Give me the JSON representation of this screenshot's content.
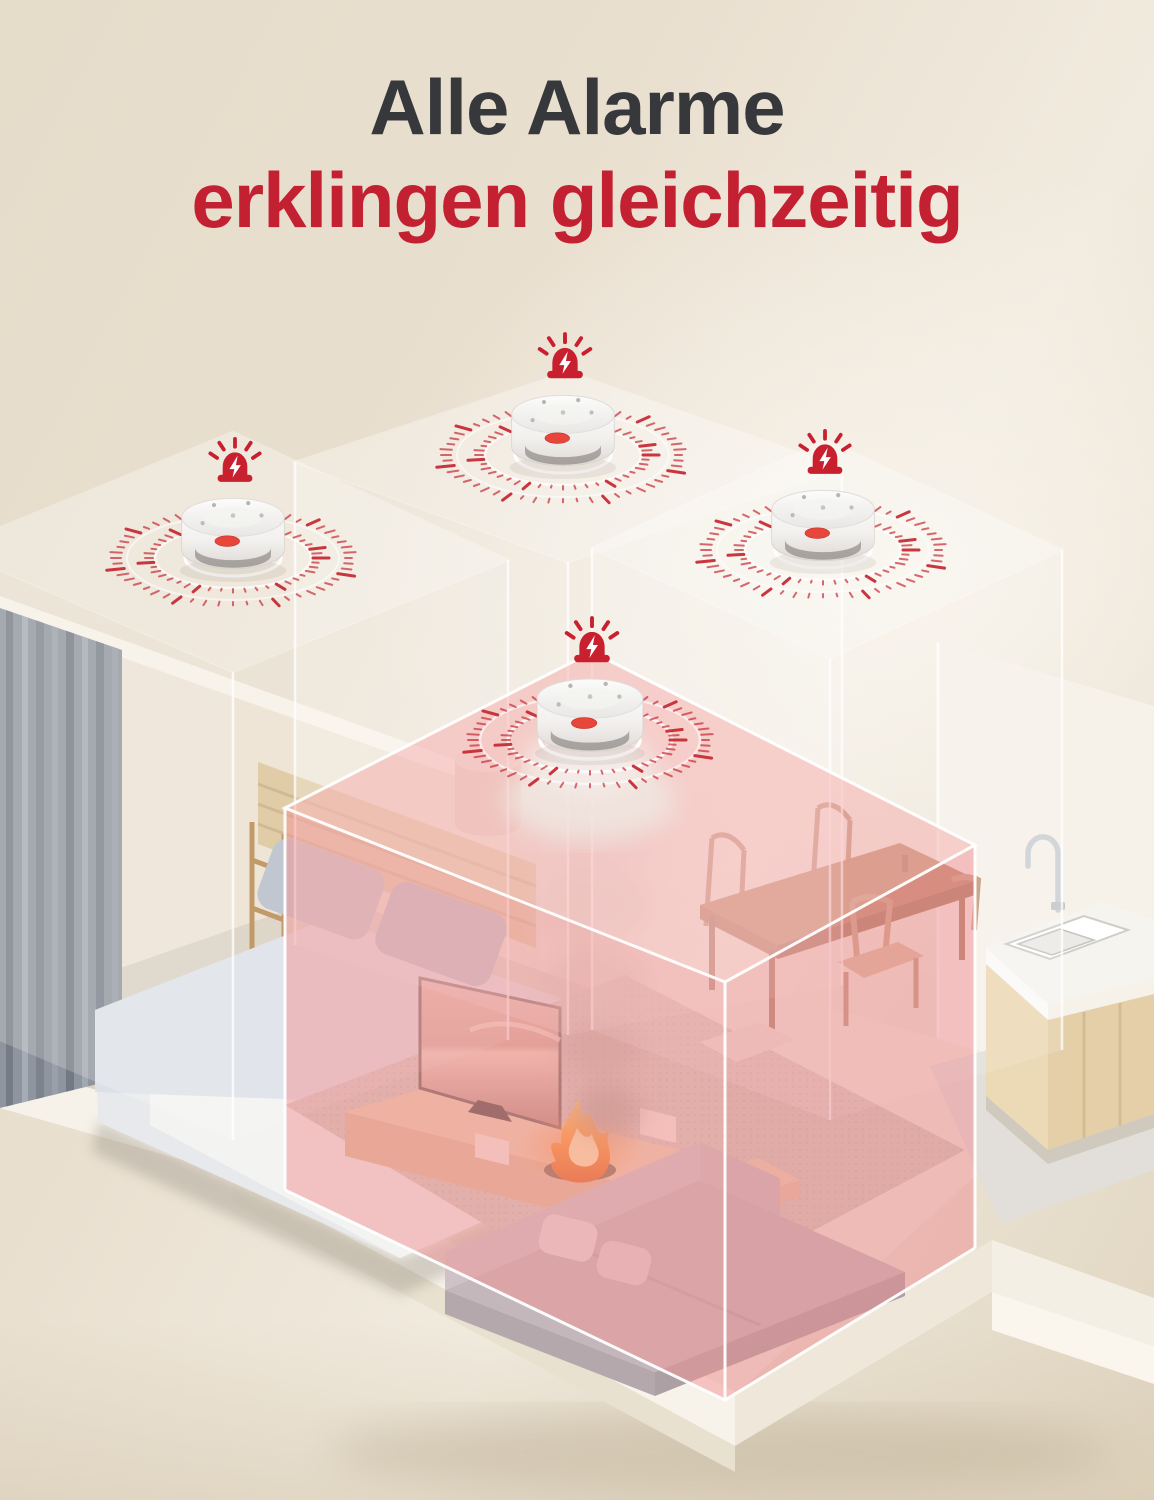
{
  "title": {
    "line1": "Alle Alarme",
    "line2": "erklingen gleichzeitig"
  },
  "colors": {
    "title_dark": "#36383b",
    "accent_red": "#c32032",
    "siren_red": "#c8202f",
    "tick_red": "#c62b35",
    "device_label_red": "#e8463a",
    "highlight_pink": "#f2a0a2",
    "background_beige": "#e7ddcb",
    "platform_white": "#f6f1e8"
  },
  "alarms": {
    "count": 4,
    "icon": "siren-lightning-icon",
    "sound_wave_style": "red-dashed-rings"
  },
  "scene": {
    "rooms": [
      "bedroom",
      "living-room",
      "dining-area",
      "kitchen"
    ],
    "highlighted_room": "living-room",
    "hazard": "fire-with-smoke"
  }
}
